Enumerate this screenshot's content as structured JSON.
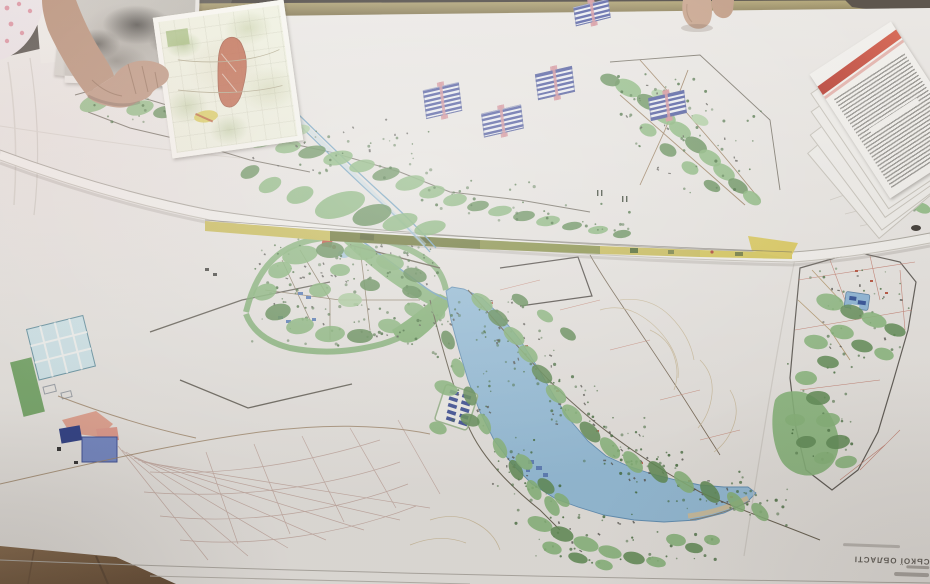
{
  "text": {
    "map_title_fragment": "СЬКОЇ ОБЛАСТІ"
  },
  "symbols": {
    "solar_panels": [
      {
        "x": 574,
        "y": 3,
        "w": 36,
        "h": 19,
        "rot": -14
      },
      {
        "x": 424,
        "y": 86,
        "w": 37,
        "h": 29,
        "rot": -13
      },
      {
        "x": 536,
        "y": 70,
        "w": 38,
        "h": 26,
        "rot": -13
      },
      {
        "x": 482,
        "y": 109,
        "w": 41,
        "h": 24,
        "rot": -13
      },
      {
        "x": 649,
        "y": 94,
        "w": 37,
        "h": 23,
        "rot": -13
      }
    ]
  },
  "colors": {
    "paper": "#e9e6e1",
    "lake_blue": "#93c1e0",
    "land_green": "#84b875",
    "dark_green": "#5e8f52",
    "panel_blue": "#4d5aa8",
    "panel_tie_pink": "#d98f98",
    "strip_yellow": "#cdbf4e",
    "strip_olive": "#6f7a33",
    "topo_red": "#c05030",
    "doc_red": "#c03428",
    "wood_rail": "#9a8a58",
    "floor_wood": "#7d5f40",
    "skin": "#bb8f73"
  }
}
